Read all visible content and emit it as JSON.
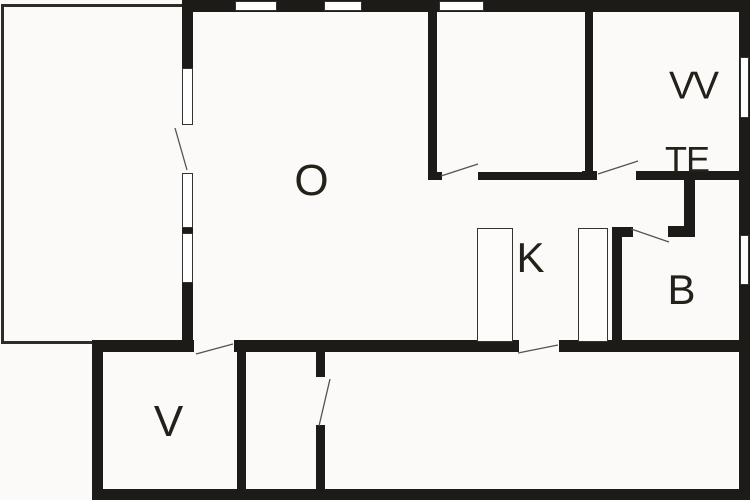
{
  "colors": {
    "bg": "#fbfaf8",
    "wall": "#1d1b18",
    "thinline": "#2e2c28",
    "frame": "#35332f",
    "text": "#232119",
    "swing": "#55534f"
  },
  "rooms": {
    "living": {
      "label": "O"
    },
    "room_top_right": {
      "label": "VV"
    },
    "toilet": {
      "label": "TE"
    },
    "kitchen": {
      "label": "K"
    },
    "bathroom": {
      "label": "B"
    },
    "bedroom": {
      "label": "V"
    }
  }
}
